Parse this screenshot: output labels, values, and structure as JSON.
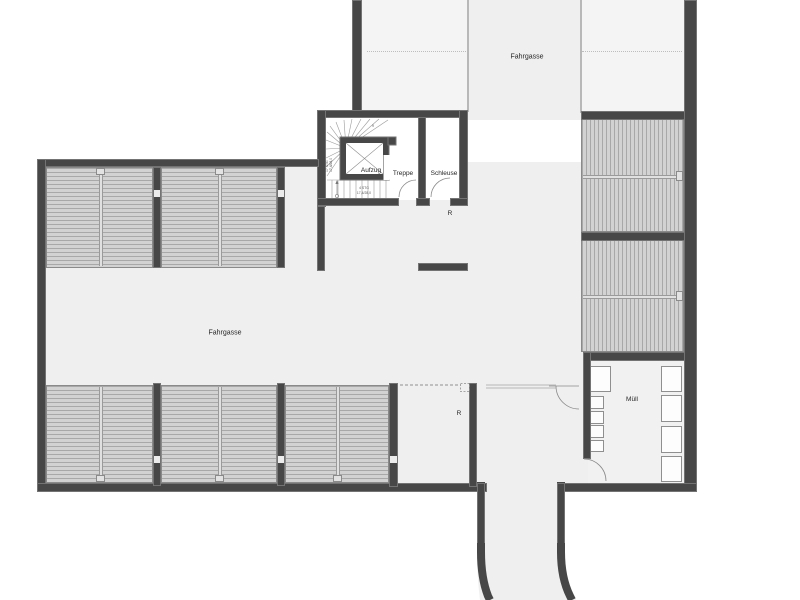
{
  "plan": {
    "labels": {
      "fahrgasse_top": "Fahrgasse",
      "fahrgasse_main": "Fahrgasse",
      "aufzug": "Aufzug",
      "treppe": "Treppe",
      "schleuse": "Schleuse",
      "r_upper": "R",
      "r_lower": "R",
      "muell": "Müll"
    },
    "stair_annotations": {
      "winder_dim": "17 STG",
      "winder_dim2": "17,4/28,0",
      "flight_dim_line1": "4 STG",
      "flight_dim_line2": "17,4/28,0",
      "tread_number": "9"
    },
    "rooms": [
      "Fahrgasse",
      "Treppe",
      "Schleuse",
      "Aufzug",
      "Müll"
    ],
    "parking_counts": {
      "top_left_double_boxes": 2,
      "bottom_double_boxes": 3,
      "right_double_boxes": 2
    },
    "muell_containers": {
      "left_large": 1,
      "left_small": 4,
      "right_large": 4
    },
    "colors": {
      "wall": "#474747",
      "wall_edge": "#737373",
      "floor": "#efefef",
      "floor_light": "#f4f4f4",
      "room_white": "#ffffff",
      "parking_fill": "#d2d2d2",
      "parking_hatch": "#a8a8a8",
      "drawing_line": "#8a8a8a"
    }
  }
}
